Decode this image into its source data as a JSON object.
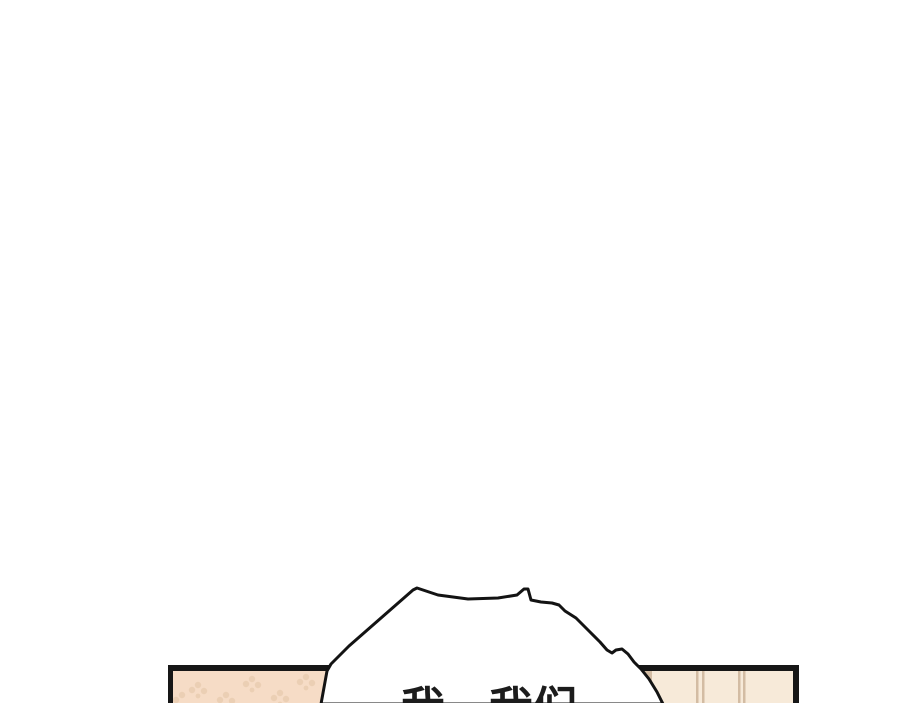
{
  "page": {
    "background_color": "#ffffff"
  },
  "comic": {
    "speech_bubble": {
      "text": "我…我们",
      "fill_color": "#ffffff",
      "outline_color": "#131313",
      "text_color": "#1c1c1c"
    },
    "left_panel": {
      "fill_color": "#f6dcc6",
      "motif_color": "#e8cbae",
      "border_color": "#161616"
    },
    "right_panel": {
      "fill_color": "#f7ead9",
      "stripe_color": "#cdb49a",
      "border_color": "#161616"
    }
  }
}
